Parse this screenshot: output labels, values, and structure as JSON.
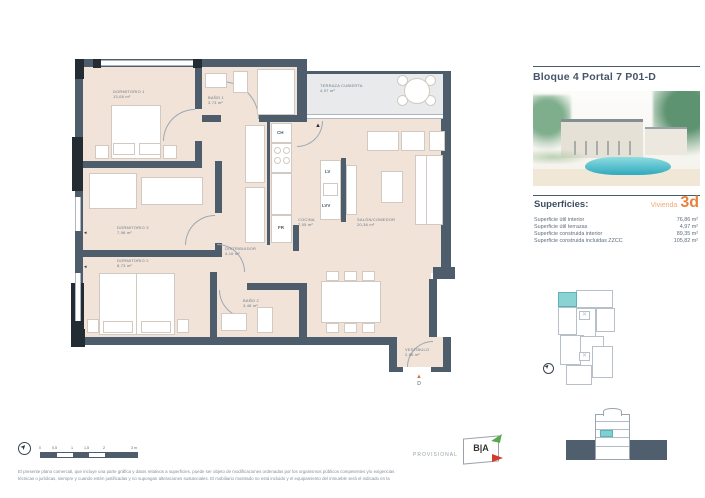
{
  "header": {
    "title": "Bloque 4 Portal 7 P01-D"
  },
  "superficies": {
    "heading": "Superficies:",
    "vivienda_label": "Vivienda",
    "vivienda_type": "3d",
    "rows": [
      {
        "label": "Superficie útil interior",
        "value": "76,86 m²"
      },
      {
        "label": "Superficie útil terrazas",
        "value": "4,97 m²"
      },
      {
        "label": "Superficie construida interior",
        "value": "89,35 m²"
      },
      {
        "label": "Superficie construida incluidas ZZCC",
        "value": "105,82 m²"
      }
    ]
  },
  "floor_plan": {
    "rooms": {
      "dormitorio1": {
        "name": "DORMITORIO 1",
        "area": "13,06 m²"
      },
      "dormitorio2": {
        "name": "DORMITORIO 2",
        "area": "8,73 m²"
      },
      "dormitorio3": {
        "name": "DORMITORIO 3",
        "area": "7,96 m²"
      },
      "bano1": {
        "name": "BAÑO 1",
        "area": "3,73 m²"
      },
      "bano2": {
        "name": "BAÑO 2",
        "area": "3,48 m²"
      },
      "cocina": {
        "name": "COCINA",
        "area": "7,05 m²"
      },
      "salon": {
        "name": "SALÓN/COMEDOR",
        "area": "20,36 m²"
      },
      "distribuidor": {
        "name": "DISTRIBUIDOR",
        "area": "4,16 m²"
      },
      "terraza": {
        "name": "TERRAZA CUBIERTA",
        "area": "4,97 m²"
      },
      "vestibulo": {
        "name": "VESTÍBULO",
        "area": "2,86 m²"
      }
    },
    "appliances": {
      "ch": "CH",
      "fr": "FR",
      "lv": "LV",
      "lvv": "LVV"
    },
    "entrance_marker": "D"
  },
  "footer": {
    "scale_labels": [
      "0",
      "0,5",
      "1",
      "1,5",
      "2",
      "3 m"
    ],
    "provisional": "PROVISIONAL",
    "energy_letters": "B|A",
    "disclaimer_line1": "El presente plano comercial, que incluye una parte gráfica y datos relativos a superficies, puede ser objeto de modificaciones ordenadas por los organismos públicos competentes y/o exigencias",
    "disclaimer_line2": "técnicas o jurídicas, siempre y cuando estén justificadas y no supongan alteraciones sustanciales. El mobiliario mostrado no está incluido y el equipamiento del inmueble será el indicado en la"
  },
  "colors": {
    "wall": "#4d5d6b",
    "floor": "#f2e3d9",
    "terrace": "#e8eaeb",
    "accent_orange": "#e8813f",
    "unit_teal": "#8ad2d4"
  }
}
